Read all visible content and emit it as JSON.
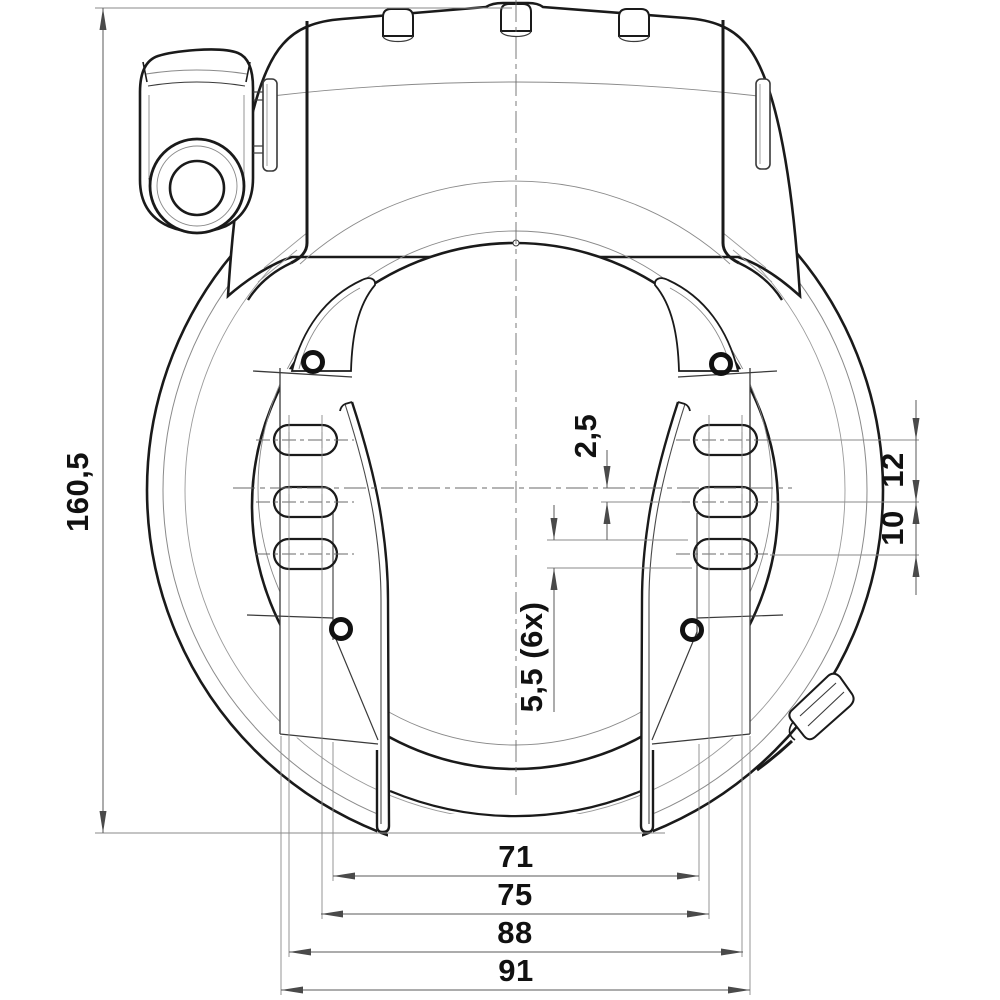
{
  "drawing": {
    "type": "technical-dimension-drawing",
    "subject": "bicycle frame ring lock, front view",
    "colors": {
      "background": "#ffffff",
      "outline_heavy": "#1a1a1a",
      "outline_medium": "#3a3a3a",
      "extension_thin": "#8a8a8a",
      "centerline": "#6a6a6a",
      "label_text": "#111111"
    },
    "dimensions": {
      "overall_height": "160,5",
      "slot_center_offset": "2,5",
      "slot_row_gap_upper": "12",
      "slot_row_gap_lower": "10",
      "slot_width_count": "5,5  (6x)",
      "bottom_width_1": "71",
      "bottom_width_2": "75",
      "bottom_width_3": "88",
      "bottom_width_4": "91"
    }
  }
}
